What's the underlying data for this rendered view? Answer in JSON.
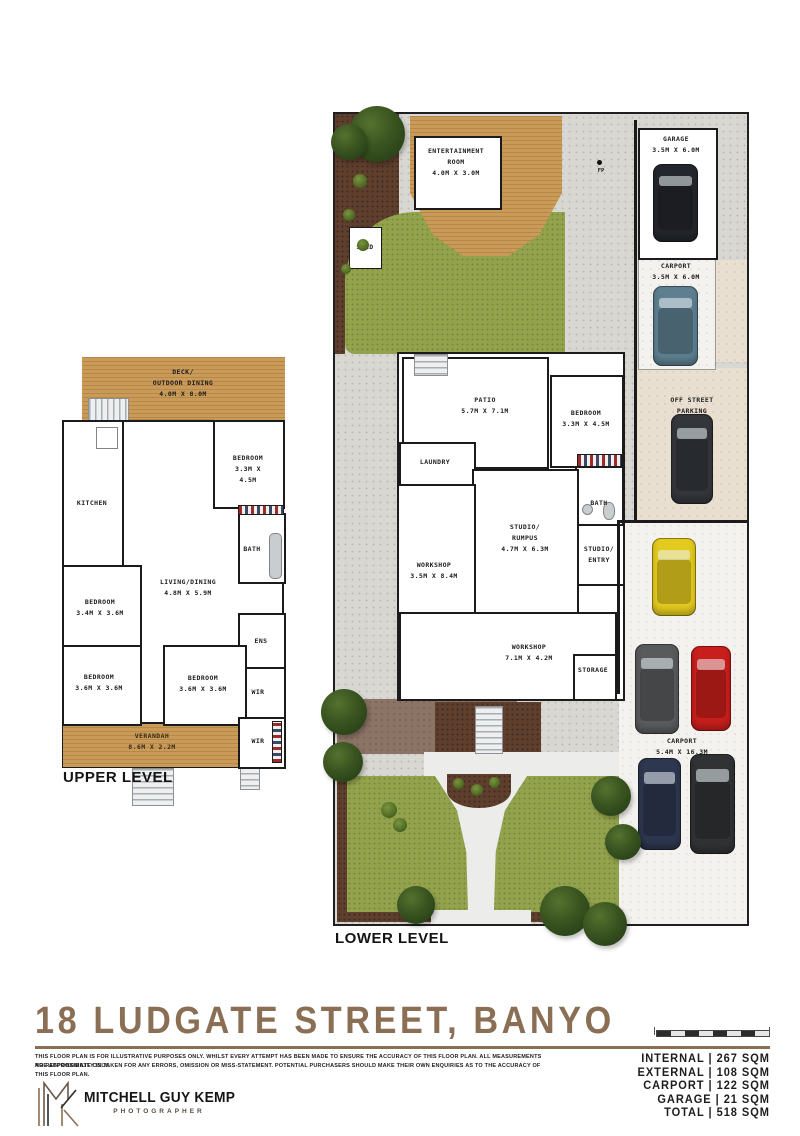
{
  "page": {
    "upper_level_label": "UPPER LEVEL",
    "lower_level_label": "LOWER LEVEL"
  },
  "upper": {
    "deck": "DECK/\nOUTDOOR DINING\n4.0M X 8.0M",
    "kitchen": "KITCHEN",
    "bedroom_tr": "BEDROOM\n3.3M X 4.5M",
    "bath": "BATH",
    "living": "LIVING/DINING\n4.8M X 5.9M",
    "bedroom_ml": "BEDROOM\n3.4M X 3.6M",
    "bedroom_bl": "BEDROOM\n3.6M X 3.6M",
    "bedroom_bm": "BEDROOM\n3.6M X 3.6M",
    "ens": "ENS",
    "wir1": "WIR",
    "wir2": "WIR",
    "verandah": "VERANDAH\n8.6M X 2.2M"
  },
  "lower": {
    "entertainment": "ENTERTAINMENT\nROOM\n4.0M X 3.0M",
    "shed": "SHED",
    "fp": "FP",
    "garage": "GARAGE\n3.5M X 6.0M",
    "carport_top": "CARPORT\n3.5M X 6.0M",
    "off_street": "OFF STREET PARKING",
    "patio": "PATIO\n5.7M X 7.1M",
    "bedroom": "BEDROOM\n3.3M X 4.5M",
    "laundry": "LAUNDRY",
    "studio_rumpus": "STUDIO/\nRUMPUS\n4.7M X 6.3M",
    "bath": "BATH",
    "studio_entry": "STUDIO/\nENTRY",
    "workshop1": "WORKSHOP\n3.5M X 8.4M",
    "workshop2": "WORKSHOP\n7.1M X 4.2M",
    "storage": "STORAGE",
    "carport_rear": "CARPORT\n5.4M X 16.3M"
  },
  "footer": {
    "title": "18 LUDGATE STREET, BANYO",
    "disclaimer1": "THIS FLOOR PLAN IS FOR ILLUSTRATIVE PURPOSES ONLY. WHILST EVERY ATTEMPT HAS BEEN MADE TO ENSURE THE ACCURACY OF THIS FLOOR PLAN. ALL MEASUREMENTS ARE APPROXIMATE ONLY.",
    "disclaimer2": "NO RESPONSIBILITY IS TAKEN FOR ANY ERRORS, OMISSION OR MISS-STATEMENT. POTENTIAL PURCHASERS SHOULD MAKE THEIR OWN ENQUIRIES AS TO THE ACCURACY OF THIS FLOOR PLAN.",
    "logo_name": "MITCHELL GUY KEMP",
    "logo_subtitle": "PHOTOGRAPHER",
    "stats": [
      {
        "text": "INTERNAL | 267 SQM"
      },
      {
        "text": "EXTERNAL | 108 SQM"
      },
      {
        "text": "CARPORT | 122 SQM"
      },
      {
        "text": "GARAGE | 21 SQM"
      },
      {
        "text": "TOTAL | 518 SQM"
      }
    ]
  },
  "colors": {
    "accent_brown": "#8a6f55",
    "deck_timber": "#c99a58",
    "grass_green": "#93a24d",
    "mulch_brown": "#5e3e2d",
    "concrete_grey": "#d8d7d2",
    "parking_beige": "#e9dfd0",
    "car_garage": "#23262c",
    "car_carport": "#5d7f8f",
    "car_offstreet": "#33363b",
    "car_yellow": "#e3ca1f",
    "car_grey": "#585a5c",
    "car_red": "#c81f1c",
    "car_navy": "#2e3750",
    "car_black": "#303234"
  }
}
